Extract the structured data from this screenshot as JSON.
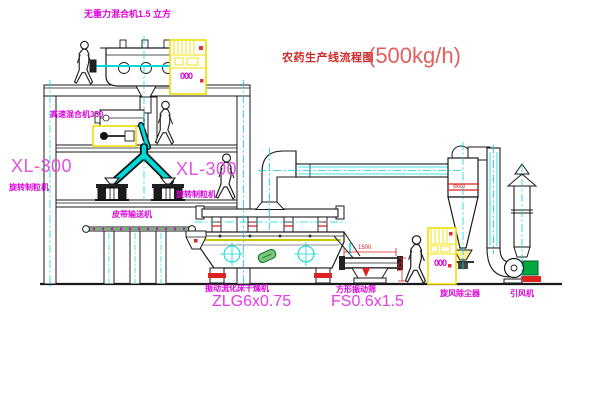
{
  "diagram": {
    "title": "农药生产线流程图",
    "capacity": "(500kg/h)",
    "equipment": {
      "gravity_mixer": "无重力混合机1.5 立方",
      "high_speed_mixer": "高速混合机350",
      "granulator_model_left": "XL-300",
      "granulator_name_left": "旋转制粒机",
      "granulator_model_right": "XL-300",
      "granulator_name_right": "旋转制粒机",
      "belt_conveyor": "皮带输送机",
      "dryer": "振动流化床干燥机",
      "dryer_model": "ZLG6x0.75",
      "sieve": "方形振动筛",
      "sieve_model": "FS0.6x1.5",
      "cyclone": "旋风除尘器",
      "fan": "引风机"
    },
    "dimensions": {
      "sieve_length": "1500",
      "sieve_height": "541",
      "cyclone_marking": "Φ800"
    },
    "cabinet_marking": "000",
    "colors": {
      "outline": "#1a1a1a",
      "centerline_cyan": "#00d9d9",
      "highlight_yellow": "#f5e400",
      "label_magenta": "#dc00dc",
      "title_red": "#cc2a2a",
      "capacity_red": "#e06060",
      "machine_green": "#00a843",
      "dimension_red": "#dd2222"
    }
  }
}
